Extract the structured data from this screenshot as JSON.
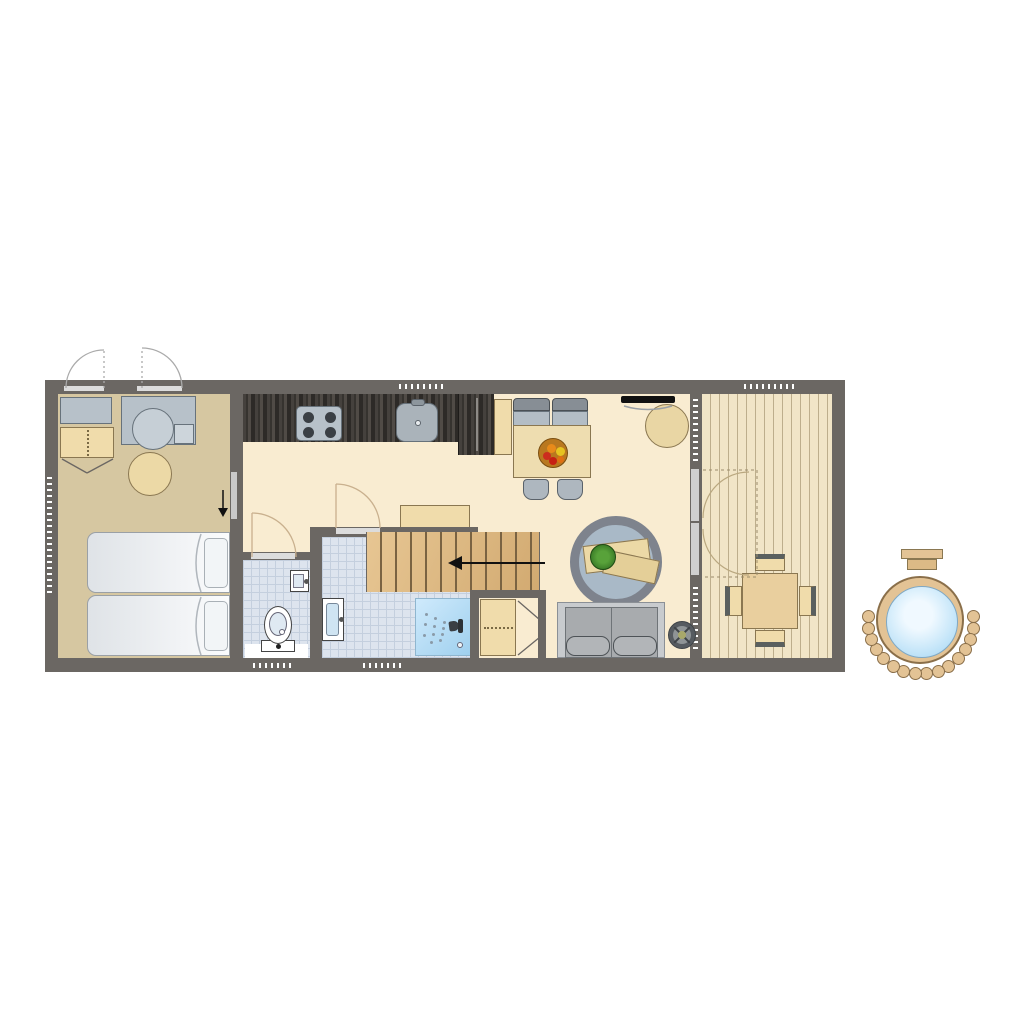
{
  "title": "Holiday lodge floor plan",
  "plan_type": "floor-plan",
  "palette": {
    "wall": "#6b6763",
    "floor_bedroom": "#d6c7a1",
    "floor_living": "#f9ecd1",
    "tile": "#dde4ee",
    "deck": "#f1e5c7",
    "wood_light": "#f0dcab",
    "stairs_wood": "#ddba85",
    "gray_unit": "#b7c1c9",
    "shower": "#abd7f1",
    "water": "#bfe3f8",
    "tub_wood": "#e3c395",
    "fruit_red": "#cc2d1e",
    "plant_green": "#3f8f2f"
  },
  "rooms": [
    {
      "name": "bedroom"
    },
    {
      "name": "hallway"
    },
    {
      "name": "kitchen"
    },
    {
      "name": "wc"
    },
    {
      "name": "bathroom"
    },
    {
      "name": "living-room"
    },
    {
      "name": "deck"
    }
  ],
  "furniture": [
    "utility-counter",
    "washing-machine",
    "wardrobe",
    "stool",
    "twin-beds",
    "kitchen-counter",
    "stove",
    "kitchen-sink",
    "tall-cabinet",
    "dining-bench",
    "dining-table",
    "fruit-bowl",
    "dining-chairs",
    "tv",
    "round-side-table",
    "hall-cabinet",
    "staircase",
    "toilet",
    "hand-basin",
    "washbasin",
    "shower",
    "closet",
    "round-rug",
    "coffee-tables",
    "plant",
    "sofa",
    "wood-stove",
    "outdoor-table",
    "outdoor-chairs",
    "hot-tub"
  ],
  "stairs": {
    "tread_count": 12,
    "direction": "left"
  },
  "hot_tub": {
    "bead_count": 16
  }
}
